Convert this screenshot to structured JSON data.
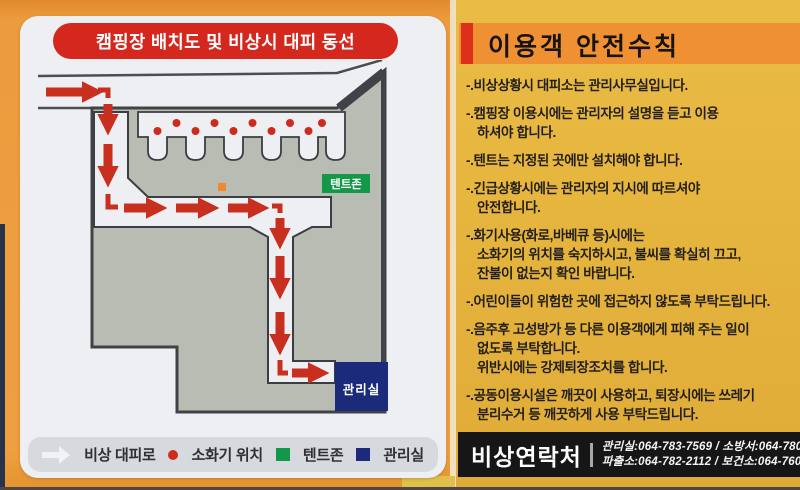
{
  "left_panel": {
    "title": "캠핑장 배치도 및 비상시 대피 동선",
    "map": {
      "tent_zone_label": "텐트존",
      "office_label": "관리실"
    },
    "legend": {
      "items": [
        {
          "marker": "route-arrow",
          "label": "비상 대피로"
        },
        {
          "marker": "red-dot",
          "label": "소화기 위치"
        },
        {
          "marker": "green-square",
          "label": "텐트존"
        },
        {
          "marker": "navy-square",
          "label": "관리실"
        }
      ]
    }
  },
  "right_panel": {
    "title": "이용객 안전수칙",
    "rules": [
      [
        "-.비상상황시 대피소는 관리사무실입니다."
      ],
      [
        "-.캠핑장 이용시에는 관리자의 설명을 듣고 이용",
        "하셔야 합니다."
      ],
      [
        "-.텐트는 지정된 곳에만 설치해야 합니다."
      ],
      [
        "-.긴급상황시에는 관리자의 지시에 따르셔야",
        "안전합니다."
      ],
      [
        "-.화기사용(화로,바베큐 등)시에는",
        "소화기의 위치를 숙지하시고, 불씨를 확실히 끄고,",
        "잔불이 없는지 확인 바랍니다."
      ],
      [
        "-.어린이들이 위험한 곳에 접근하지 않도록 부탁드립니다."
      ],
      [
        "-.음주후 고성방가 등 다른 이용객에게 피해 주는 일이",
        "없도록 부탁합니다.",
        "위반시에는 강제퇴장조치를 합니다."
      ],
      [
        "-.공동이용시설은 깨끗이 사용하고, 퇴장시에는 쓰레기",
        "분리수거 등 깨끗하게 사용 부탁드립니다."
      ]
    ],
    "contacts": {
      "title": "비상연락처",
      "line1": "관리실:064-783-7569 / 소방서:064-780-9134",
      "line2": "파출소:064-782-2112 / 보건소:064-760-6151"
    }
  },
  "colors": {
    "left_background": "#ee9f40",
    "right_background": "#e5b43d",
    "card": "#edeff2",
    "title_pill_red": "#d4271e",
    "rules_bar_orange": "#ef9133",
    "accent_red": "#de2e1c",
    "contact_bar_black": "#161616",
    "camp_gray": "#b8bcb3",
    "map_outline": "#3f4347",
    "evacuation_red": "#c92f1f",
    "tent_zone_green": "#13984a",
    "office_navy": "#1c2a7b"
  }
}
